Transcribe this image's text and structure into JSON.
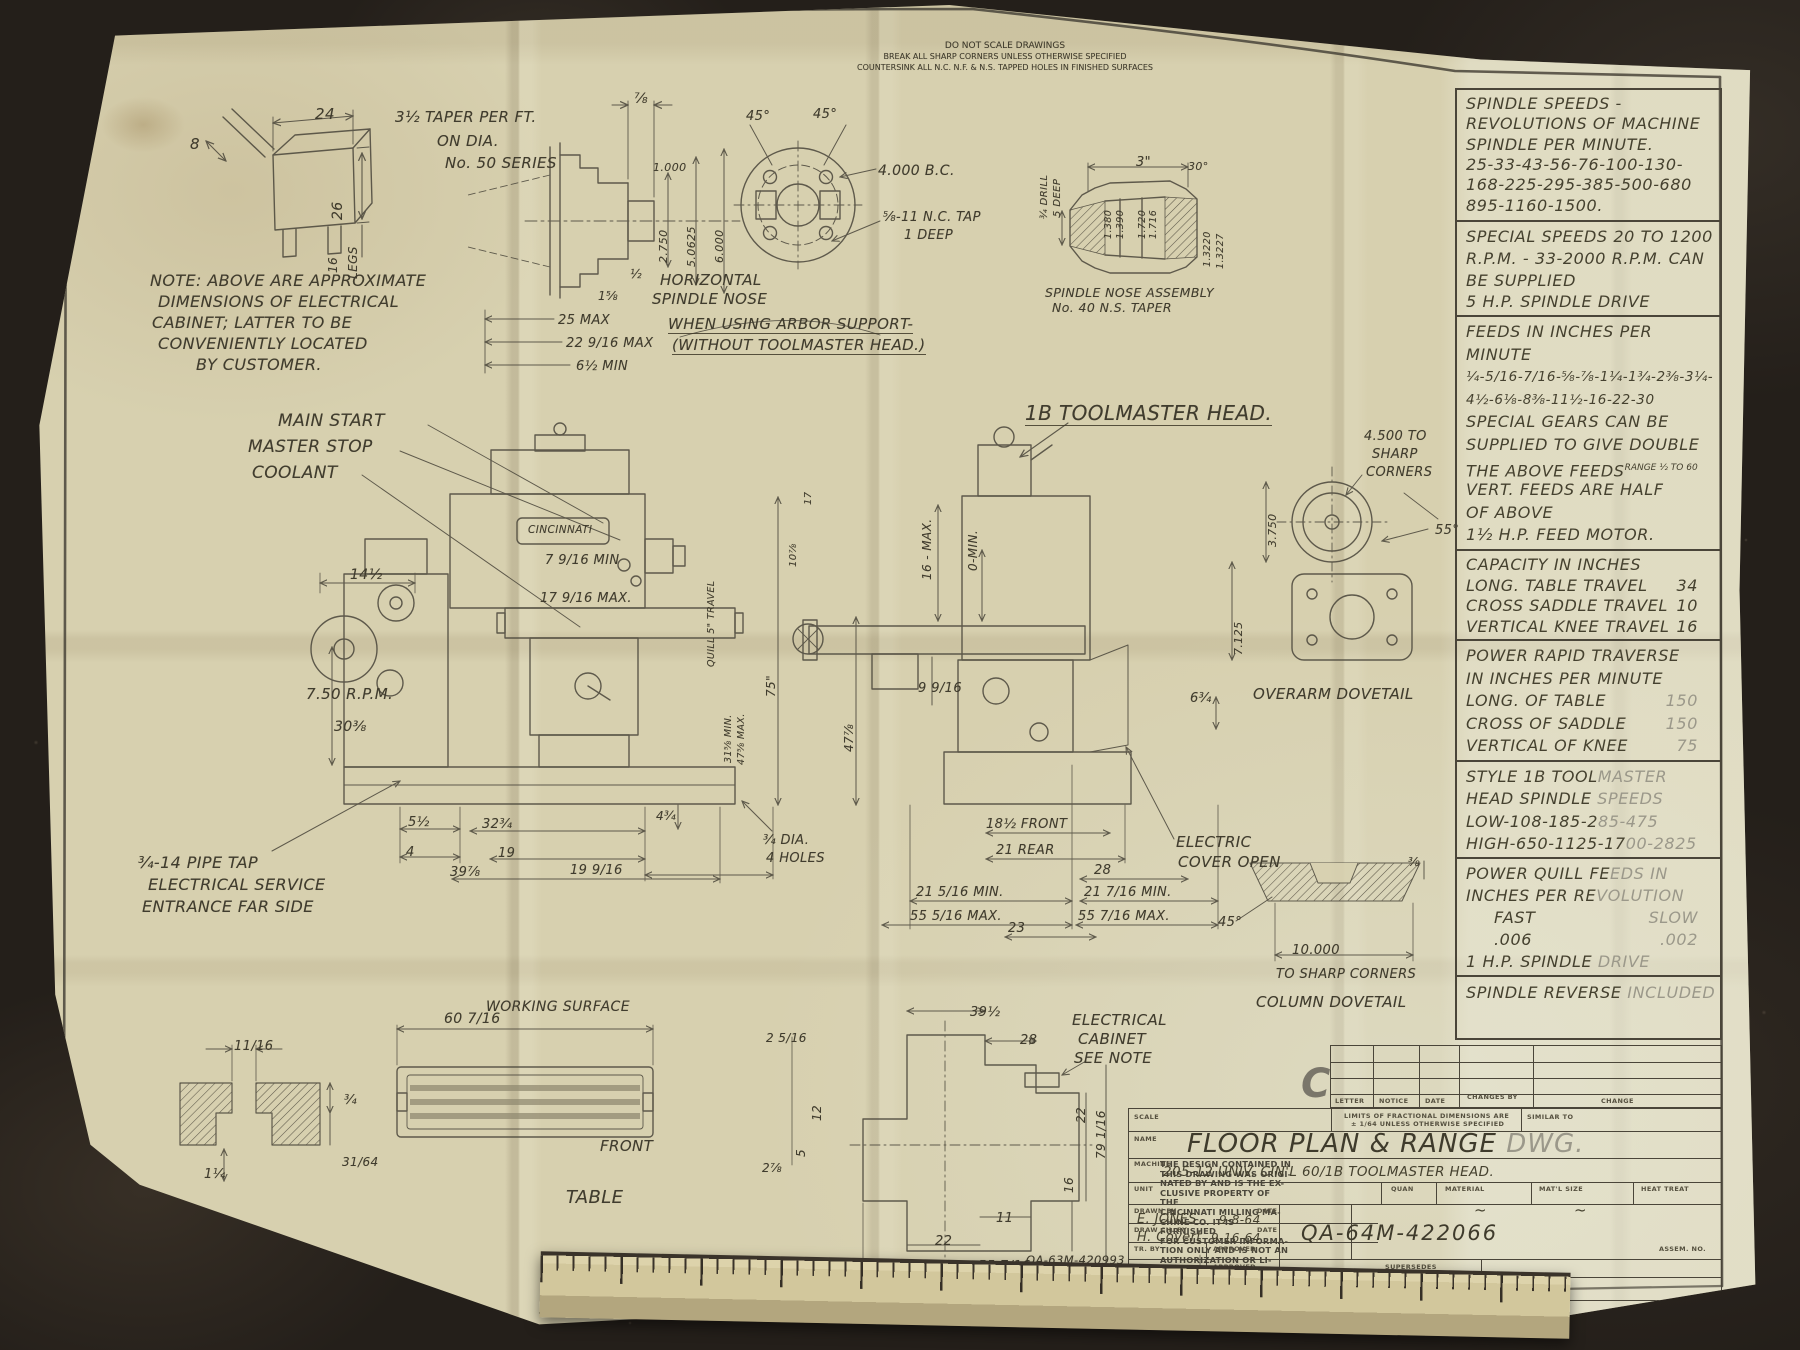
{
  "document": {
    "type": "engineering-drawing-photo",
    "title": "FLOOR PLAN & RANGE DWG.",
    "drawing_number": "QA-64M-422066",
    "company": "THE CINCINNATI MILLING MACHINE CO."
  },
  "palette": {
    "bg": "#241f1a",
    "paper": "#d7d0af",
    "ink": "#45412f",
    "faded_ink": "#9b988a"
  },
  "top_notes": [
    "DO NOT SCALE DRAWINGS",
    "BREAK ALL SHARP CORNERS UNLESS OTHERWISE SPECIFIED",
    "COUNTERSINK ALL N.C. N.F. & N.S. TAPPED HOLES IN FINISHED SURFACES"
  ],
  "right_column": {
    "blocks": [
      {
        "y": 0,
        "h": 130,
        "lines": [
          {
            "t": "SPINDLE SPEEDS -"
          },
          {
            "t": "REVOLUTIONS OF MACHINE"
          },
          {
            "t": "SPINDLE PER MINUTE."
          },
          {
            "t": "25-33-43-56-76-100-130-"
          },
          {
            "t": "168-225-295-385-500-680"
          },
          {
            "t": "895-1160-1500."
          }
        ]
      },
      {
        "y": 130,
        "h": 95,
        "lines": [
          {
            "t": "SPECIAL SPEEDS 20 TO 1200"
          },
          {
            "t": "R.P.M. - 33-2000 R.P.M. CAN"
          },
          {
            "t": "BE SUPPLIED"
          },
          {
            "t": "5 H.P. SPINDLE DRIVE"
          }
        ]
      },
      {
        "y": 225,
        "h": 234,
        "lines": [
          {
            "t": "FEEDS IN INCHES PER"
          },
          {
            "t": "MINUTE"
          },
          {
            "t": "¼-5/16-7/16-⅝-⅞-1¼-1¾-2⅜-3¼-",
            "s": 13.5
          },
          {
            "t": "4½-6⅛-8⅜-11½-16-22-30",
            "s": 13.5
          },
          {
            "t": "SPECIAL GEARS CAN BE"
          },
          {
            "t": "SUPPLIED TO GIVE DOUBLE"
          },
          {
            "t": "THE ABOVE FEEDS",
            "sup": "RANGE ½ TO 60"
          },
          {
            "t": "VERT. FEEDS ARE HALF"
          },
          {
            "t": "OF ABOVE"
          },
          {
            "t": "1½ H.P. FEED MOTOR."
          }
        ]
      },
      {
        "y": 459,
        "h": 90,
        "lines": [
          {
            "t": "CAPACITY IN INCHES"
          },
          {
            "t": "LONG. TABLE TRAVEL",
            "v": "34"
          },
          {
            "t": "CROSS SADDLE TRAVEL",
            "v": "10"
          },
          {
            "t": "VERTICAL KNEE TRAVEL",
            "v": "16"
          }
        ]
      },
      {
        "y": 549,
        "h": 121,
        "lines": [
          {
            "t": "POWER RAPID TRAVERSE"
          },
          {
            "t": "IN INCHES PER MINUTE"
          },
          {
            "t": "LONG. OF TABLE",
            "v": "150",
            "vf": 1
          },
          {
            "t": "CROSS OF SADDLE",
            "v": "150",
            "vf": 1
          },
          {
            "t": "VERTICAL OF KNEE",
            "v": "75",
            "vf": 1
          }
        ]
      },
      {
        "y": 670,
        "h": 97,
        "lines": [
          {
            "t": "STYLE 1B TOOL",
            "t2": "MASTER"
          },
          {
            "t": "HEAD SPINDLE ",
            "t2": "SPEEDS"
          },
          {
            "t": "LOW-108-185-2",
            "t2": "85-475"
          },
          {
            "t": "HIGH-650-1125-17",
            "t2": "00-2825"
          }
        ]
      },
      {
        "y": 767,
        "h": 118,
        "lines": [
          {
            "t": "POWER QUILL FE",
            "t2": "EDS IN"
          },
          {
            "t": "INCHES PER RE",
            "t2": "VOLUTION"
          },
          {
            "t": "FAST",
            "v": "SLOW",
            "vf": 1,
            "ind": 1
          },
          {
            "t": ".006",
            "v": ".002",
            "vf": 1,
            "ind": 1
          },
          {
            "t": "1 H.P. SPINDLE ",
            "t2": "DRIVE"
          }
        ]
      },
      {
        "y": 885,
        "h": 67,
        "lines": [
          {
            "t": "SPINDLE REVERSE ",
            "t2": "INCLUDED"
          }
        ]
      }
    ]
  },
  "title_block": {
    "rev_letter": "C",
    "rev_headers": [
      "LETTER",
      "NOTICE",
      "DATE",
      "CHANGES BY",
      "CHANGE"
    ],
    "scale_label": "SCALE",
    "limits_line1": "LIMITS OF FRACTIONAL DIMENSIONS ARE",
    "limits_line2": "± 1/64 UNLESS OTHERWISE SPECIFIED",
    "similar_to_label": "SIMILAR TO",
    "name_label": "NAME",
    "name_value": "FLOOR PLAN & RANGE ",
    "name_value_faded": "DWG.",
    "machine_label": "MACHINE",
    "machine_value": "205-12 UNIV. CIN'L 60/1B TOOLMASTER HEAD.",
    "unit_label": "UNIT",
    "quan_label": "QUAN",
    "material_label": "MATERIAL",
    "material_value": "~",
    "matl_size_label": "MAT'L SIZE",
    "matl_size_value": "~",
    "heat_treat_label": "HEAT TREAT",
    "drawn_by_label": "DRAWN BY",
    "drawn_by_value": "E. JONES",
    "date_label": "DATE",
    "drawn_date": "9-8-64",
    "draw_ch_label": "DRAW CH. BY",
    "draw_ch_value": "H. Covert",
    "draw_ch_date": "9-16-64",
    "tr_by_label": "TR. BY",
    "tr_ch_label": "TR. CH. BY",
    "approved_label": "APPROVED",
    "supersedes_label": "SUPERSEDES",
    "superseded_by_label": "SUPERSEDED BY",
    "assem_no_label": "ASSEM. NO.",
    "drawing_number": "QA-64M-422066",
    "company": "THE CINCINNATI MILLING MACHINE CO."
  },
  "disclaimer": {
    "lines": [
      "THE DESIGN CONTAINED IN",
      "THIS DRAWING WAS ORIGI-",
      "NATED BY AND IS THE EX-",
      "CLUSIVE PROPERTY OF THE",
      "CINCINNATI MILLING MA-",
      "CHINE CO. IT IS FURNISHED",
      "FOR CUSTOMER INFORMA-",
      "TION ONLY AND IS NOT AN",
      "AUTHORIZATION OR LI-",
      "CENSE TO MAKE THIS CON-",
      "STRUCTION OR TO FURNISH",
      "THIS INFORMATION TO",
      "OTHERS."
    ]
  },
  "annotations": [
    {
      "t": "DO NOT SCALE DRAWINGS",
      "x": 985,
      "y": 36,
      "s": 9,
      "ctr": 1,
      "cls": "print"
    },
    {
      "t": "BREAK ALL SHARP CORNERS UNLESS OTHERWISE SPECIFIED",
      "x": 985,
      "y": 47,
      "s": 8,
      "ctr": 1,
      "cls": "print"
    },
    {
      "t": "COUNTERSINK ALL N.C. N.F. & N.S. TAPPED HOLES IN FINISHED SURFACES",
      "x": 985,
      "y": 58,
      "s": 8,
      "ctr": 1,
      "cls": "print"
    },
    {
      "t": "24",
      "x": 295,
      "y": 100,
      "s": 15
    },
    {
      "t": "8",
      "x": 170,
      "y": 130,
      "s": 15
    },
    {
      "t": "26",
      "x": 310,
      "y": 215,
      "s": 14,
      "r": -90
    },
    {
      "t": "16",
      "x": 306,
      "y": 268,
      "s": 12,
      "r": -90
    },
    {
      "t": "LEGS",
      "x": 326,
      "y": 274,
      "s": 12,
      "r": -90
    },
    {
      "t": "NOTE: ABOVE ARE APPROXIMATE",
      "x": 130,
      "y": 266,
      "s": 16
    },
    {
      "t": "DIMENSIONS OF ELECTRICAL",
      "x": 138,
      "y": 287,
      "s": 16
    },
    {
      "t": "CABINET; LATTER TO BE",
      "x": 132,
      "y": 308,
      "s": 16
    },
    {
      "t": "CONVENIENTLY LOCATED",
      "x": 138,
      "y": 329,
      "s": 16
    },
    {
      "t": "BY CUSTOMER.",
      "x": 176,
      "y": 350,
      "s": 16
    },
    {
      "t": "3½ TAPER PER FT.",
      "x": 375,
      "y": 103,
      "s": 15
    },
    {
      "t": "ON DIA.",
      "x": 417,
      "y": 127,
      "s": 15
    },
    {
      "t": "No. 50 SERIES",
      "x": 425,
      "y": 149,
      "s": 15
    },
    {
      "t": "⅞",
      "x": 614,
      "y": 86,
      "s": 14
    },
    {
      "t": "1.000",
      "x": 633,
      "y": 156,
      "s": 11
    },
    {
      "t": "2.750",
      "x": 637,
      "y": 258,
      "s": 11,
      "r": -90
    },
    {
      "t": "5.0625",
      "x": 665,
      "y": 262,
      "s": 11,
      "r": -90
    },
    {
      "t": "6.000",
      "x": 693,
      "y": 258,
      "s": 11,
      "r": -90
    },
    {
      "t": "½",
      "x": 610,
      "y": 262,
      "s": 12
    },
    {
      "t": "1⅝",
      "x": 578,
      "y": 284,
      "s": 12
    },
    {
      "t": "HORIZONTAL",
      "x": 640,
      "y": 266,
      "s": 15
    },
    {
      "t": "SPINDLE NOSE",
      "x": 632,
      "y": 285,
      "s": 15
    },
    {
      "t": "45°",
      "x": 726,
      "y": 104,
      "s": 13
    },
    {
      "t": "45°",
      "x": 793,
      "y": 102,
      "s": 13
    },
    {
      "t": "4.000 B.C.",
      "x": 858,
      "y": 158,
      "s": 14
    },
    {
      "t": "⅝-11 N.C. TAP",
      "x": 863,
      "y": 205,
      "s": 13
    },
    {
      "t": "1 DEEP",
      "x": 884,
      "y": 223,
      "s": 13
    },
    {
      "t": "3\"",
      "x": 1116,
      "y": 150,
      "s": 13
    },
    {
      "t": "¾ DRILL",
      "x": 1019,
      "y": 214,
      "s": 10,
      "r": -90
    },
    {
      "t": "5 DEEP",
      "x": 1032,
      "y": 212,
      "s": 10,
      "r": -90
    },
    {
      "t": "1.380",
      "x": 1083,
      "y": 234,
      "s": 9.5,
      "r": -90
    },
    {
      "t": "1.390",
      "x": 1095,
      "y": 234,
      "s": 9.5,
      "r": -90
    },
    {
      "t": "1.720",
      "x": 1117,
      "y": 234,
      "s": 9.5,
      "r": -90
    },
    {
      "t": "1.716",
      "x": 1128,
      "y": 234,
      "s": 9.5,
      "r": -90
    },
    {
      "t": "30°",
      "x": 1168,
      "y": 155,
      "s": 11
    },
    {
      "t": "1.3220",
      "x": 1182,
      "y": 262,
      "s": 9.5,
      "r": -90
    },
    {
      "t": "1.3227",
      "x": 1195,
      "y": 264,
      "s": 9.5,
      "r": -90
    },
    {
      "t": "SPINDLE NOSE ASSEMBLY",
      "x": 1025,
      "y": 280,
      "s": 12.5
    },
    {
      "t": "No. 40 N.S. TAPER",
      "x": 1032,
      "y": 295,
      "s": 12.5
    },
    {
      "t": "25  MAX",
      "x": 538,
      "y": 308,
      "s": 13
    },
    {
      "t": "22 9/16 MAX",
      "x": 546,
      "y": 331,
      "s": 13
    },
    {
      "t": "6½ MIN",
      "x": 556,
      "y": 354,
      "s": 13
    },
    {
      "t": "WHEN USING ARBOR SUPPORT-",
      "x": 648,
      "y": 310,
      "s": 15,
      "u": 1
    },
    {
      "t": "(WITHOUT TOOLMASTER HEAD.)",
      "x": 652,
      "y": 331,
      "s": 15,
      "u": 1
    },
    {
      "t": "1B TOOLMASTER HEAD.",
      "x": 1005,
      "y": 396,
      "s": 20,
      "u": 1
    },
    {
      "t": "4.500 TO",
      "x": 1344,
      "y": 424,
      "s": 13
    },
    {
      "t": "SHARP",
      "x": 1352,
      "y": 442,
      "s": 13
    },
    {
      "t": "CORNERS",
      "x": 1346,
      "y": 460,
      "s": 13
    },
    {
      "t": "55°",
      "x": 1415,
      "y": 518,
      "s": 13
    },
    {
      "t": "3.750",
      "x": 1246,
      "y": 542,
      "s": 11,
      "r": -90
    },
    {
      "t": "7.125",
      "x": 1212,
      "y": 650,
      "s": 11,
      "r": -90
    },
    {
      "t": "MAIN START",
      "x": 258,
      "y": 406,
      "s": 17
    },
    {
      "t": "MASTER STOP",
      "x": 228,
      "y": 432,
      "s": 17
    },
    {
      "t": "COOLANT",
      "x": 232,
      "y": 458,
      "s": 17
    },
    {
      "t": "CINCINNATI",
      "x": 508,
      "y": 519,
      "s": 10.5
    },
    {
      "t": "14½",
      "x": 330,
      "y": 562,
      "s": 14
    },
    {
      "t": "7 9/16 MIN",
      "x": 525,
      "y": 548,
      "s": 13
    },
    {
      "t": "17 9/16 MAX.",
      "x": 520,
      "y": 586,
      "s": 13
    },
    {
      "t": "7.50 R.P.M.",
      "x": 286,
      "y": 680,
      "s": 15
    },
    {
      "t": "30⅜",
      "x": 314,
      "y": 714,
      "s": 14
    },
    {
      "t": "75\"",
      "x": 744,
      "y": 692,
      "s": 12,
      "r": -90
    },
    {
      "t": "QUILL 5\" TRAVEL",
      "x": 686,
      "y": 662,
      "s": 9.5,
      "r": -90
    },
    {
      "t": "17",
      "x": 783,
      "y": 500,
      "s": 10,
      "r": -90
    },
    {
      "t": "10⅞",
      "x": 768,
      "y": 562,
      "s": 10,
      "r": -90
    },
    {
      "t": "31⅝ MIN.",
      "x": 703,
      "y": 758,
      "s": 9.5,
      "r": -90
    },
    {
      "t": "47⅝ MAX.",
      "x": 716,
      "y": 760,
      "s": 9.5,
      "r": -90
    },
    {
      "t": "5½",
      "x": 388,
      "y": 810,
      "s": 13
    },
    {
      "t": "4",
      "x": 386,
      "y": 840,
      "s": 13
    },
    {
      "t": "32¾",
      "x": 462,
      "y": 812,
      "s": 13
    },
    {
      "t": "19",
      "x": 478,
      "y": 841,
      "s": 13
    },
    {
      "t": "39⅞",
      "x": 430,
      "y": 860,
      "s": 13
    },
    {
      "t": "19 9/16",
      "x": 550,
      "y": 858,
      "s": 13
    },
    {
      "t": "4¾",
      "x": 636,
      "y": 804,
      "s": 12
    },
    {
      "t": "¾ DIA.",
      "x": 743,
      "y": 828,
      "s": 13
    },
    {
      "t": "4 HOLES",
      "x": 746,
      "y": 846,
      "s": 13
    },
    {
      "t": "¾-14 PIPE TAP",
      "x": 118,
      "y": 848,
      "s": 16
    },
    {
      "t": "ELECTRICAL SERVICE",
      "x": 128,
      "y": 870,
      "s": 16
    },
    {
      "t": "ENTRANCE FAR SIDE",
      "x": 122,
      "y": 892,
      "s": 16
    },
    {
      "t": "16 - MAX.",
      "x": 900,
      "y": 575,
      "s": 12,
      "r": -90
    },
    {
      "t": "0-MIN.",
      "x": 946,
      "y": 566,
      "s": 12,
      "r": -90
    },
    {
      "t": "9 9/16",
      "x": 898,
      "y": 676,
      "s": 13
    },
    {
      "t": "47⅞",
      "x": 822,
      "y": 747,
      "s": 12,
      "r": -90
    },
    {
      "t": "6¾",
      "x": 1170,
      "y": 686,
      "s": 13
    },
    {
      "t": "OVERARM  DOVETAIL",
      "x": 1233,
      "y": 680,
      "s": 15
    },
    {
      "t": "18½ FRONT",
      "x": 966,
      "y": 812,
      "s": 13
    },
    {
      "t": "21 REAR",
      "x": 976,
      "y": 838,
      "s": 13
    },
    {
      "t": "28",
      "x": 1074,
      "y": 858,
      "s": 13
    },
    {
      "t": "21 5/16 MIN.",
      "x": 896,
      "y": 880,
      "s": 13
    },
    {
      "t": "55 5/16 MAX.",
      "x": 890,
      "y": 904,
      "s": 13
    },
    {
      "t": "21 7/16 MIN.",
      "x": 1064,
      "y": 880,
      "s": 13
    },
    {
      "t": "55 7/16 MAX.",
      "x": 1058,
      "y": 904,
      "s": 13
    },
    {
      "t": "23",
      "x": 988,
      "y": 916,
      "s": 13
    },
    {
      "t": "ELECTRIC",
      "x": 1156,
      "y": 828,
      "s": 15
    },
    {
      "t": "COVER OPEN",
      "x": 1158,
      "y": 848,
      "s": 15
    },
    {
      "t": "⅜",
      "x": 1388,
      "y": 850,
      "s": 12
    },
    {
      "t": "45°",
      "x": 1198,
      "y": 910,
      "s": 13
    },
    {
      "t": "10.000",
      "x": 1272,
      "y": 938,
      "s": 13
    },
    {
      "t": "TO SHARP CORNERS",
      "x": 1256,
      "y": 962,
      "s": 13
    },
    {
      "t": "COLUMN DOVETAIL",
      "x": 1236,
      "y": 988,
      "s": 15
    },
    {
      "t": "60 7/16",
      "x": 424,
      "y": 1006,
      "s": 14
    },
    {
      "t": "WORKING SURFACE",
      "x": 466,
      "y": 994,
      "s": 14
    },
    {
      "t": "FRONT",
      "x": 580,
      "y": 1132,
      "s": 15
    },
    {
      "t": "TABLE",
      "x": 546,
      "y": 1182,
      "s": 18
    },
    {
      "t": "2 5/16",
      "x": 746,
      "y": 1026,
      "s": 12
    },
    {
      "t": "12",
      "x": 790,
      "y": 1116,
      "s": 12,
      "r": -90
    },
    {
      "t": "5",
      "x": 774,
      "y": 1152,
      "s": 12,
      "r": -90
    },
    {
      "t": "2⅞",
      "x": 742,
      "y": 1156,
      "s": 12
    },
    {
      "t": "11/16",
      "x": 214,
      "y": 1034,
      "s": 13
    },
    {
      "t": "¾",
      "x": 324,
      "y": 1088,
      "s": 13
    },
    {
      "t": "31/64",
      "x": 322,
      "y": 1150,
      "s": 12
    },
    {
      "t": "1¼",
      "x": 184,
      "y": 1162,
      "s": 13
    },
    {
      "t": "TABLE SLOT",
      "x": 202,
      "y": 1244,
      "s": 17
    },
    {
      "t": "39½",
      "x": 950,
      "y": 1000,
      "s": 13
    },
    {
      "t": "28",
      "x": 1000,
      "y": 1028,
      "s": 13
    },
    {
      "t": "ELECTRICAL",
      "x": 1052,
      "y": 1006,
      "s": 15
    },
    {
      "t": "CABINET",
      "x": 1058,
      "y": 1025,
      "s": 15
    },
    {
      "t": "SEE NOTE",
      "x": 1054,
      "y": 1044,
      "s": 15
    },
    {
      "t": "22",
      "x": 1054,
      "y": 1118,
      "s": 12,
      "r": -90
    },
    {
      "t": "79 1/16",
      "x": 1074,
      "y": 1154,
      "s": 12,
      "r": -90
    },
    {
      "t": "16",
      "x": 1042,
      "y": 1188,
      "s": 12,
      "r": -90
    },
    {
      "t": "11",
      "x": 976,
      "y": 1206,
      "s": 13
    },
    {
      "t": "22",
      "x": 915,
      "y": 1229,
      "s": 13
    },
    {
      "t": "55 7/16",
      "x": 958,
      "y": 1254,
      "s": 13
    },
    {
      "t": "110¾",
      "x": 892,
      "y": 1276,
      "s": 13
    },
    {
      "t": "QA-63M-420993",
      "x": 1006,
      "y": 1248,
      "s": 11.5
    },
    {
      "t": "189580",
      "x": 1026,
      "y": 1262,
      "s": 11.5
    },
    {
      "t": "186666",
      "x": 1026,
      "y": 1275,
      "s": 11.5
    },
    {
      "t": "REF. DRWGS.",
      "x": 1142,
      "y": 1260,
      "s": 13
    }
  ]
}
